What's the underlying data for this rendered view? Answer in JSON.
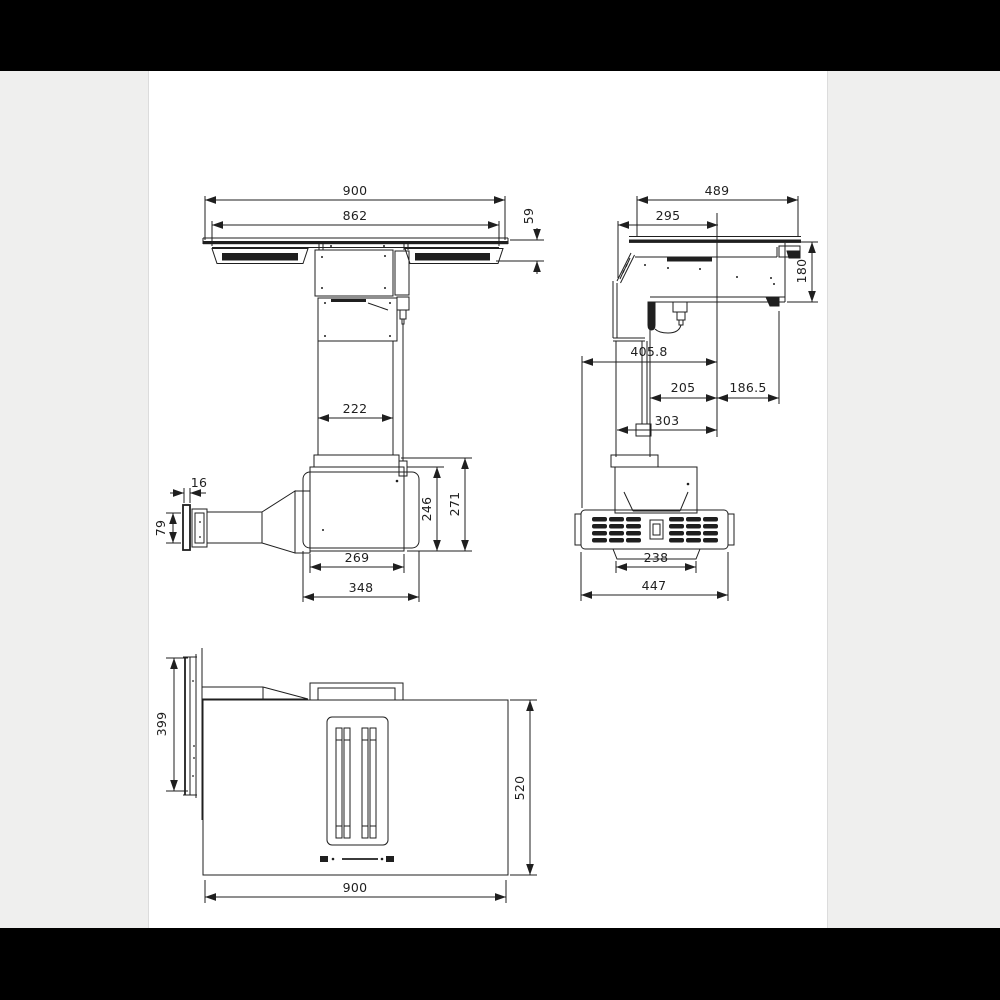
{
  "colors": {
    "letterbox": "#000000",
    "margin": "#efefee",
    "panel": "#ffffff",
    "line": "#1f1f1f"
  },
  "front_view": {
    "dims": {
      "total_width": "900",
      "glass_width": "862",
      "edge_height": "59",
      "column_width": "222",
      "flange_offset": "16",
      "duct_height": "79",
      "motor_box_width": "269",
      "base_width": "348",
      "motor_box_height": "246",
      "motor_box_total_height": "271"
    }
  },
  "side_view": {
    "dims": {
      "total_depth": "489",
      "glass_front_depth": "295",
      "body_height": "180",
      "overall_depth": "405.8",
      "column_front_offset": "205",
      "rear_offset": "186.5",
      "column_rear_offset": "303",
      "vent_width": "238",
      "vent_total_width": "447"
    }
  },
  "bottom_view": {
    "dims": {
      "flange_length": "399",
      "body_depth": "520",
      "body_width": "900"
    }
  }
}
